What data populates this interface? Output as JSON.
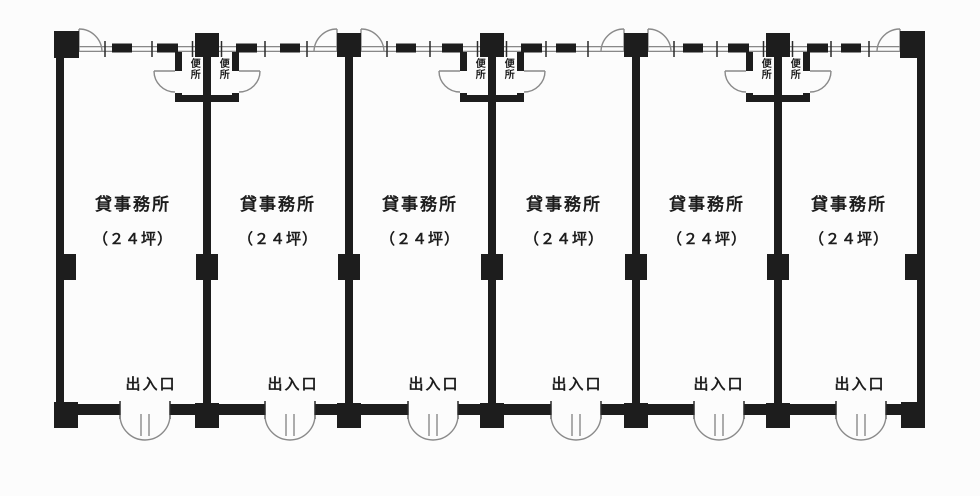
{
  "floorplan": {
    "units": [
      {
        "name": "貸事務所",
        "area": "（２４坪）",
        "entrance": "出入口"
      },
      {
        "name": "貸事務所",
        "area": "（２４坪）",
        "entrance": "出入口"
      },
      {
        "name": "貸事務所",
        "area": "（２４坪）",
        "entrance": "出入口"
      },
      {
        "name": "貸事務所",
        "area": "（２４坪）",
        "entrance": "出入口"
      },
      {
        "name": "貸事務所",
        "area": "（２４坪）",
        "entrance": "出入口"
      },
      {
        "name": "貸事務所",
        "area": "（２４坪）",
        "entrance": "出入口"
      }
    ],
    "toilets": [
      {
        "left": "便所",
        "right": "便所"
      },
      {
        "left": "便所",
        "right": "便所"
      },
      {
        "left": "便所",
        "right": "便所"
      }
    ],
    "colors": {
      "wall": "#1d1d1d",
      "door_line": "#8a8a8a",
      "window_line": "#787878",
      "background": "#fcfcfc"
    }
  }
}
